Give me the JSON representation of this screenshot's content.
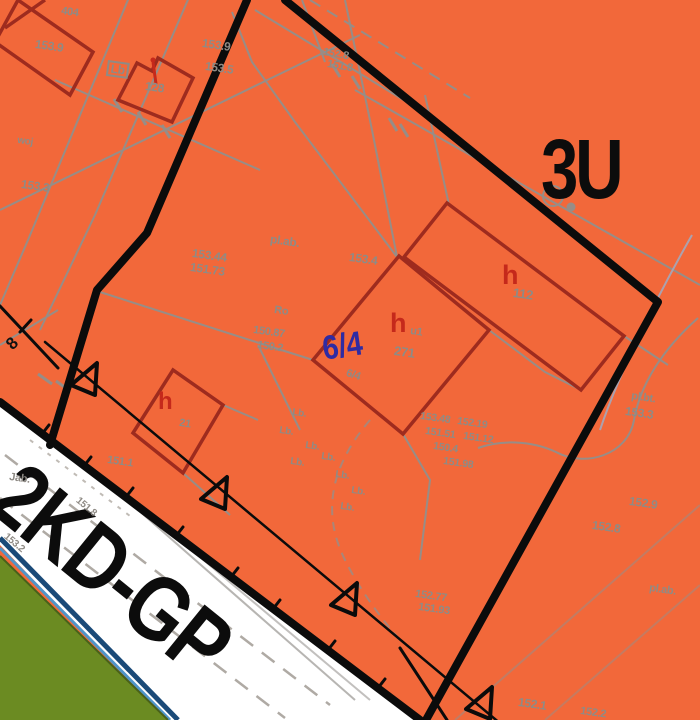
{
  "map": {
    "zone_label": "3U",
    "road_label": "2KD-GP",
    "parcel_label": "6/4",
    "section_label": "8"
  },
  "colors": {
    "zone_fill_orange": "#F2683A",
    "cadastral_gray": "#8F8B85",
    "building_outline_red": "#9E2B1E",
    "building_label_red": "#C5291B",
    "plan_boundary_black": "#0B0B0B",
    "parcel_navy": "#2F2BA3",
    "road_white": "#FFFFFF",
    "greenery": "#6B8B22",
    "water_line_light": "#5095C9",
    "water_line_dark": "#1A4A78",
    "utility_lavender": "#A8A5B5"
  },
  "map_labels": [
    {
      "t": "404",
      "x": 62,
      "y": 6,
      "s": 11,
      "r": 8,
      "c": "g",
      "n": "elevation-label"
    },
    {
      "t": "153.9",
      "x": 36,
      "y": 38,
      "s": 12,
      "r": 8,
      "c": "g",
      "n": "elevation-label"
    },
    {
      "t": "153.9",
      "x": 203,
      "y": 37,
      "s": 12,
      "r": 8,
      "c": "g",
      "n": "elevation-label"
    },
    {
      "t": "153.5",
      "x": 206,
      "y": 60,
      "s": 12,
      "r": 8,
      "c": "g",
      "n": "elevation-label"
    },
    {
      "t": "Lb",
      "x": 108,
      "y": 60,
      "s": 12,
      "r": 8,
      "c": "g",
      "b": 1,
      "n": "landuse-label"
    },
    {
      "t": "128",
      "x": 146,
      "y": 80,
      "s": 12,
      "r": 8,
      "c": "g",
      "n": "building-number-label"
    },
    {
      "t": "woj",
      "x": 18,
      "y": 136,
      "s": 10,
      "r": 8,
      "c": "g",
      "n": "map-label"
    },
    {
      "t": "153.3",
      "x": 22,
      "y": 178,
      "s": 12,
      "r": 8,
      "c": "g",
      "n": "elevation-label"
    },
    {
      "t": "152.8",
      "x": 324,
      "y": 47,
      "s": 11,
      "r": 10,
      "c": "g",
      "n": "elevation-label"
    },
    {
      "t": "151.8",
      "x": 328,
      "y": 59,
      "s": 11,
      "r": 10,
      "c": "g",
      "n": "elevation-label"
    },
    {
      "t": "153.44",
      "x": 193,
      "y": 247,
      "s": 12,
      "r": 8,
      "c": "g",
      "n": "elevation-label"
    },
    {
      "t": "151.73",
      "x": 191,
      "y": 261,
      "s": 12,
      "r": 8,
      "c": "g",
      "n": "elevation-label"
    },
    {
      "t": "pl.ab.",
      "x": 271,
      "y": 233,
      "s": 12,
      "r": 8,
      "c": "g",
      "n": "landuse-label"
    },
    {
      "t": "153.4",
      "x": 350,
      "y": 251,
      "s": 12,
      "r": 8,
      "c": "g",
      "n": "elevation-label"
    },
    {
      "t": "Ro",
      "x": 275,
      "y": 305,
      "s": 11,
      "r": 8,
      "c": "g",
      "n": "landuse-label"
    },
    {
      "t": "150.87",
      "x": 254,
      "y": 325,
      "s": 11,
      "r": 8,
      "c": "g",
      "n": "elevation-label"
    },
    {
      "t": "150.2",
      "x": 258,
      "y": 340,
      "s": 11,
      "r": 8,
      "c": "g",
      "n": "elevation-label"
    },
    {
      "t": "h",
      "x": 390,
      "y": 310,
      "s": 27,
      "r": 0,
      "c": "red",
      "n": "building-height-label"
    },
    {
      "t": "u1",
      "x": 411,
      "y": 326,
      "s": 11,
      "r": 8,
      "c": "g",
      "n": "building-number-label"
    },
    {
      "t": "271",
      "x": 395,
      "y": 344,
      "s": 13,
      "r": 8,
      "c": "g",
      "n": "building-number-label"
    },
    {
      "t": "h",
      "x": 502,
      "y": 262,
      "s": 27,
      "r": 0,
      "c": "red",
      "n": "building-height-label"
    },
    {
      "t": "112",
      "x": 514,
      "y": 286,
      "s": 13,
      "r": 8,
      "c": "g",
      "n": "building-number-label"
    },
    {
      "t": "h",
      "x": 158,
      "y": 390,
      "s": 24,
      "r": 0,
      "c": "red",
      "n": "building-height-label"
    },
    {
      "t": "21",
      "x": 180,
      "y": 418,
      "s": 11,
      "r": 8,
      "c": "g",
      "n": "building-number-label"
    },
    {
      "t": "6/4",
      "x": 348,
      "y": 368,
      "s": 11,
      "r": 18,
      "c": "g",
      "n": "parcel-number-gray"
    },
    {
      "t": "Lb.",
      "x": 293,
      "y": 408,
      "s": 10,
      "r": 8,
      "c": "g",
      "n": "landuse-label"
    },
    {
      "t": "Lb.",
      "x": 280,
      "y": 426,
      "s": 10,
      "r": 8,
      "c": "g",
      "n": "landuse-label"
    },
    {
      "t": "Lb.",
      "x": 306,
      "y": 441,
      "s": 10,
      "r": 8,
      "c": "g",
      "n": "landuse-label"
    },
    {
      "t": "Lb.",
      "x": 291,
      "y": 457,
      "s": 10,
      "r": 8,
      "c": "g",
      "n": "landuse-label"
    },
    {
      "t": "Lb.",
      "x": 322,
      "y": 452,
      "s": 10,
      "r": 8,
      "c": "g",
      "n": "landuse-label"
    },
    {
      "t": "Lb.",
      "x": 336,
      "y": 470,
      "s": 10,
      "r": 8,
      "c": "g",
      "n": "landuse-label"
    },
    {
      "t": "Lb.",
      "x": 352,
      "y": 486,
      "s": 10,
      "r": 8,
      "c": "g",
      "n": "landuse-label"
    },
    {
      "t": "Lb.",
      "x": 341,
      "y": 502,
      "s": 10,
      "r": 8,
      "c": "g",
      "n": "landuse-label"
    },
    {
      "t": "153.48",
      "x": 421,
      "y": 411,
      "s": 10.5,
      "r": 8,
      "c": "g",
      "n": "elevation-label"
    },
    {
      "t": "152.19",
      "x": 458,
      "y": 416,
      "s": 10.5,
      "r": 8,
      "c": "g",
      "n": "elevation-label"
    },
    {
      "t": "151.51",
      "x": 426,
      "y": 426,
      "s": 10.5,
      "r": 8,
      "c": "g",
      "n": "elevation-label"
    },
    {
      "t": "151.12",
      "x": 464,
      "y": 431,
      "s": 10.5,
      "r": 8,
      "c": "g",
      "n": "elevation-label"
    },
    {
      "t": "150.4",
      "x": 434,
      "y": 441,
      "s": 10.5,
      "r": 8,
      "c": "g",
      "n": "elevation-label"
    },
    {
      "t": "151.98",
      "x": 444,
      "y": 456,
      "s": 10.5,
      "r": 8,
      "c": "g",
      "n": "elevation-label"
    },
    {
      "t": "152.77",
      "x": 416,
      "y": 589,
      "s": 11,
      "r": 8,
      "c": "g",
      "n": "elevation-label"
    },
    {
      "t": "151.93",
      "x": 419,
      "y": 602,
      "s": 11,
      "r": 8,
      "c": "g",
      "n": "elevation-label"
    },
    {
      "t": "pl.bt.",
      "x": 632,
      "y": 391,
      "s": 11,
      "r": 8,
      "c": "g",
      "n": "landuse-label"
    },
    {
      "t": "153.3",
      "x": 626,
      "y": 405,
      "s": 12,
      "r": 8,
      "c": "g",
      "n": "elevation-label"
    },
    {
      "t": "152.9",
      "x": 630,
      "y": 495,
      "s": 12,
      "r": 8,
      "c": "g",
      "n": "elevation-label"
    },
    {
      "t": "152.8",
      "x": 593,
      "y": 519,
      "s": 12,
      "r": 8,
      "c": "g",
      "n": "elevation-label"
    },
    {
      "t": "pl.ab.",
      "x": 650,
      "y": 583,
      "s": 11,
      "r": 8,
      "c": "g",
      "n": "landuse-label"
    },
    {
      "t": "152.1",
      "x": 519,
      "y": 696,
      "s": 12,
      "r": 8,
      "c": "g",
      "n": "elevation-label"
    },
    {
      "t": "152.2",
      "x": 581,
      "y": 706,
      "s": 11,
      "r": 8,
      "c": "g",
      "n": "elevation-label"
    },
    {
      "t": "Jab.",
      "x": 10,
      "y": 472,
      "s": 11,
      "r": 8,
      "c": "g",
      "n": "landuse-label"
    },
    {
      "t": "151.1",
      "x": 108,
      "y": 455,
      "s": 11,
      "r": 8,
      "c": "g",
      "n": "elevation-label"
    },
    {
      "t": "151.8",
      "x": 80,
      "y": 496,
      "s": 10,
      "r": 40,
      "c": "g",
      "n": "elevation-label"
    },
    {
      "t": "153.2",
      "x": 8,
      "y": 532,
      "s": 10,
      "r": 40,
      "c": "g",
      "n": "elevation-label"
    }
  ]
}
